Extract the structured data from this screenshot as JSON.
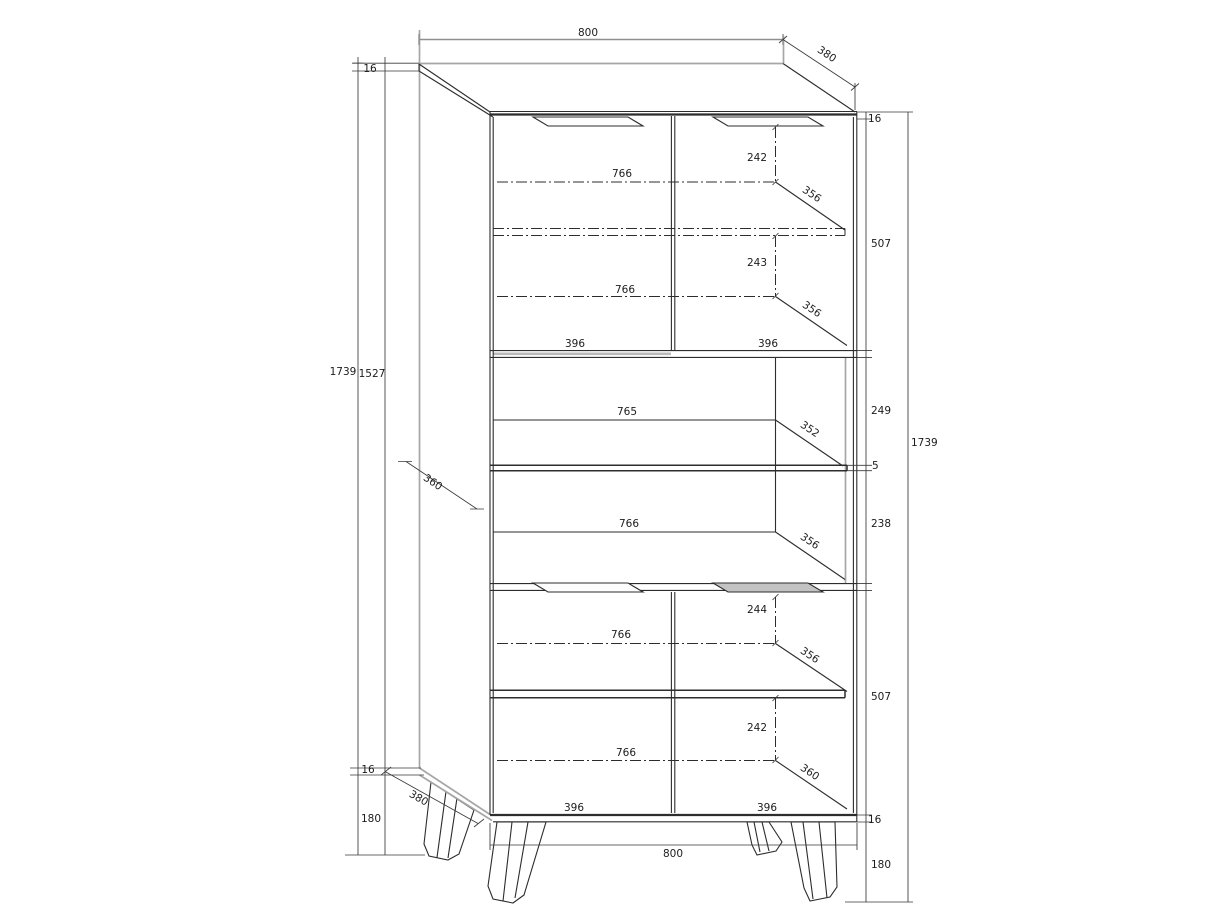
{
  "meta": {
    "title": "Cabinet technical drawing",
    "units": "mm"
  },
  "dims": {
    "top": {
      "width": "800",
      "depth": "380",
      "thickness_left": "16",
      "thickness_right": "16"
    },
    "left": {
      "total_height": "1739",
      "inner_height": "1527",
      "mid_depth": "360",
      "bottom_thickness": "16",
      "leg_height": "180",
      "bottom_depth": "380"
    },
    "right": {
      "top_section": "507",
      "upper_shelf_offset": "249",
      "shelf_gap": "5",
      "lower_shelf_offset": "238",
      "total_height": "1739",
      "bottom_section": "507",
      "bottom_thickness": "16",
      "leg_height": "180"
    },
    "bottom": {
      "width": "800"
    },
    "top_section": {
      "top_clearance": "242",
      "shelf_width_upper": "766",
      "depth_upper": "356",
      "bottom_clearance": "243",
      "shelf_width_lower": "766",
      "depth_lower": "356",
      "door_width_left": "396",
      "door_width_right": "396"
    },
    "middle_section": {
      "shelf_width_upper": "765",
      "depth_upper": "352",
      "shelf_width_lower": "766",
      "depth_lower": "356"
    },
    "bottom_section": {
      "top_clearance": "244",
      "shelf_width_upper": "766",
      "depth_upper": "356",
      "bottom_clearance": "242",
      "shelf_width_lower": "766",
      "depth_lower": "360",
      "door_width_left": "396",
      "door_width_right": "396"
    }
  }
}
